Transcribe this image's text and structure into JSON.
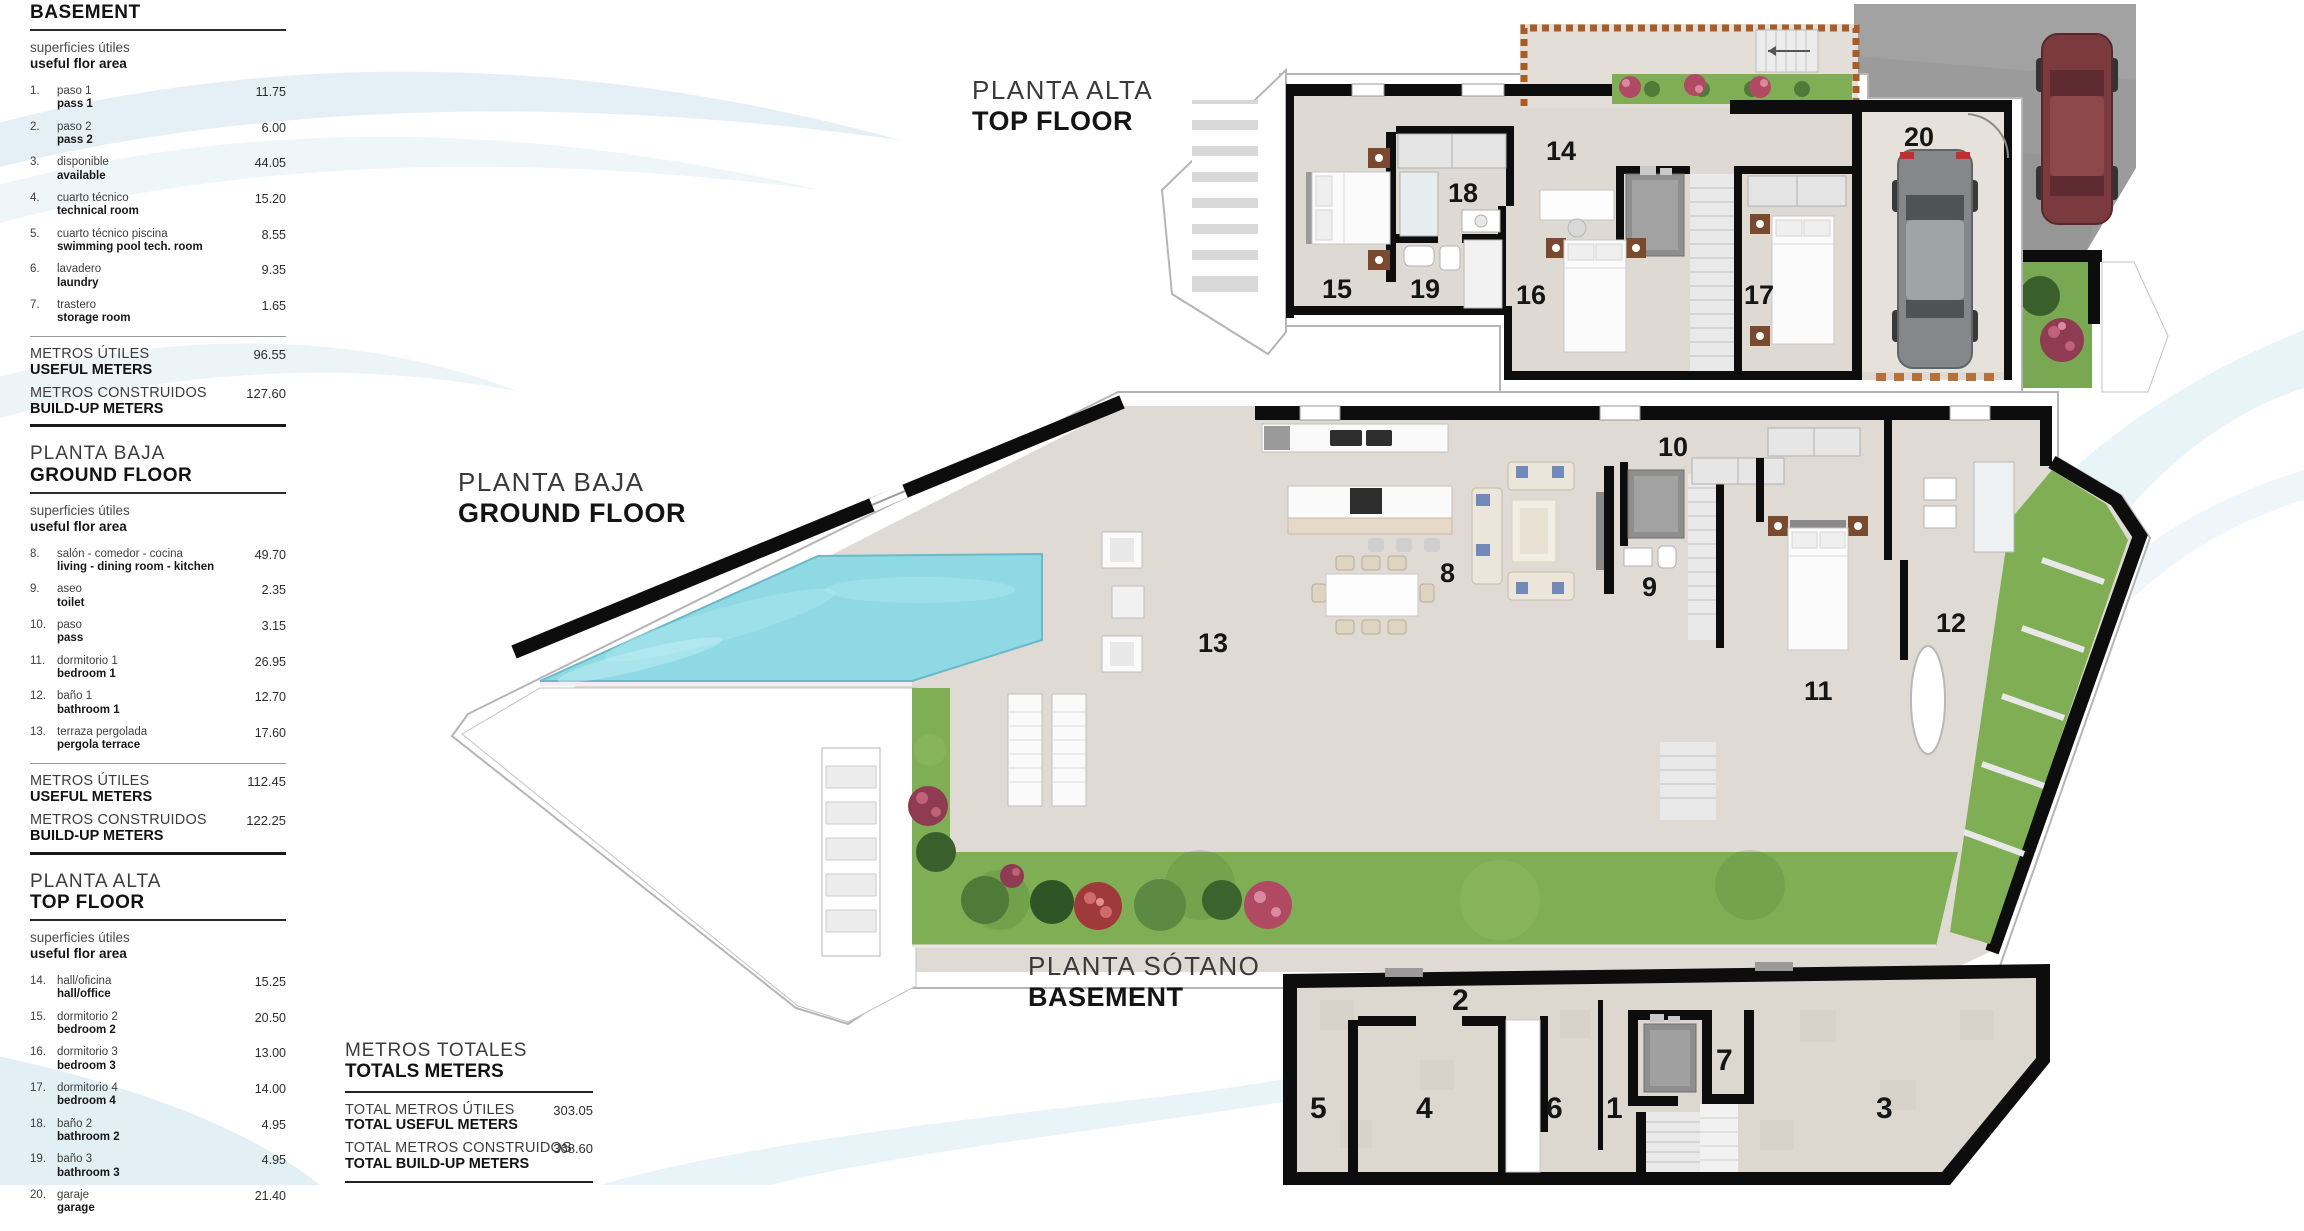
{
  "sidebar": {
    "sections": [
      {
        "heading_es": "",
        "heading_en": "BASEMENT",
        "sub_es": "superficies útiles",
        "sub_en": "useful flor area",
        "items": [
          {
            "num": "1.",
            "es": "paso 1",
            "en": "pass 1",
            "value": "11.75"
          },
          {
            "num": "2.",
            "es": "paso 2",
            "en": "pass 2",
            "value": "6.00"
          },
          {
            "num": "3.",
            "es": "disponible",
            "en": "available",
            "value": "44.05"
          },
          {
            "num": "4.",
            "es": "cuarto técnico",
            "en": "technical room",
            "value": "15.20"
          },
          {
            "num": "5.",
            "es": "cuarto técnico piscina",
            "en": "swimming pool tech. room",
            "value": "8.55"
          },
          {
            "num": "6.",
            "es": "lavadero",
            "en": "laundry",
            "value": "9.35"
          },
          {
            "num": "7.",
            "es": "trastero",
            "en": "storage room",
            "value": "1.65"
          }
        ],
        "totals": [
          {
            "es": "METROS ÚTILES",
            "en": "USEFUL METERS",
            "value": "96.55"
          },
          {
            "es": "METROS CONSTRUIDOS",
            "en": "BUILD-UP METERS",
            "value": "127.60"
          }
        ]
      },
      {
        "heading_es": "PLANTA BAJA",
        "heading_en": "GROUND FLOOR",
        "sub_es": "superficies útiles",
        "sub_en": "useful flor area",
        "items": [
          {
            "num": "8.",
            "es": "salón - comedor - cocina",
            "en": "living - dining room - kitchen",
            "value": "49.70"
          },
          {
            "num": "9.",
            "es": "aseo",
            "en": "toilet",
            "value": "2.35"
          },
          {
            "num": "10.",
            "es": "paso",
            "en": "pass",
            "value": "3.15"
          },
          {
            "num": "11.",
            "es": "dormitorio 1",
            "en": "bedroom 1",
            "value": "26.95"
          },
          {
            "num": "12.",
            "es": "baño 1",
            "en": "bathroom 1",
            "value": "12.70"
          },
          {
            "num": "13.",
            "es": "terraza pergolada",
            "en": "pergola terrace",
            "value": "17.60"
          }
        ],
        "totals": [
          {
            "es": "METROS ÚTILES",
            "en": "USEFUL METERS",
            "value": "112.45"
          },
          {
            "es": "METROS CONSTRUIDOS",
            "en": "BUILD-UP METERS",
            "value": "122.25"
          }
        ]
      },
      {
        "heading_es": "PLANTA ALTA",
        "heading_en": "TOP FLOOR",
        "sub_es": "superficies útiles",
        "sub_en": "useful flor area",
        "items": [
          {
            "num": "14.",
            "es": "hall/oficina",
            "en": "hall/office",
            "value": "15.25"
          },
          {
            "num": "15.",
            "es": "dormitorio 2",
            "en": "bedroom 2",
            "value": "20.50"
          },
          {
            "num": "16.",
            "es": "dormitorio 3",
            "en": "bedroom 3",
            "value": "13.00"
          },
          {
            "num": "17.",
            "es": "dormitorio 4",
            "en": "bedroom 4",
            "value": "14.00"
          },
          {
            "num": "18.",
            "es": "baño 2",
            "en": "bathroom 2",
            "value": "4.95"
          },
          {
            "num": "19.",
            "es": "baño 3",
            "en": "bathroom 3",
            "value": "4.95"
          },
          {
            "num": "20.",
            "es": "garaje",
            "en": "garage",
            "value": "21.40"
          }
        ],
        "totals": []
      }
    ]
  },
  "totals_block": {
    "title_es": "METROS TOTALES",
    "title_en": "TOTALS METERS",
    "rows": [
      {
        "es": "TOTAL METROS ÚTILES",
        "en": "TOTAL USEFUL METERS",
        "value": "303.05"
      },
      {
        "es": "TOTAL METROS CONSTRUIDOS",
        "en": "TOTAL BUILD-UP METERS",
        "value": "368.60"
      }
    ]
  },
  "plans": {
    "top_floor": {
      "label_es": "PLANTA ALTA",
      "label_en": "TOP FLOOR",
      "rooms": [
        "14",
        "15",
        "16",
        "17",
        "18",
        "19",
        "20"
      ]
    },
    "ground_floor": {
      "label_es": "PLANTA BAJA",
      "label_en": "GROUND FLOOR",
      "rooms": [
        "8",
        "9",
        "10",
        "11",
        "12",
        "13"
      ]
    },
    "basement": {
      "label_es": "PLANTA SÓTANO",
      "label_en": "BASEMENT",
      "rooms": [
        "1",
        "2",
        "3",
        "4",
        "5",
        "6",
        "7"
      ]
    }
  },
  "colors": {
    "wall": "#0d0d0d",
    "floor": "#dedad3",
    "terrace_floor": "#e3dfd8",
    "pool": "#8ed9e4",
    "grass": "#7fae55",
    "driveway": "#9b9b9b",
    "accent_wood": "#a85c28",
    "car_red": "#7b3a3e",
    "car_gray": "#85898c",
    "swoosh_blue": "#cfe4ee"
  }
}
